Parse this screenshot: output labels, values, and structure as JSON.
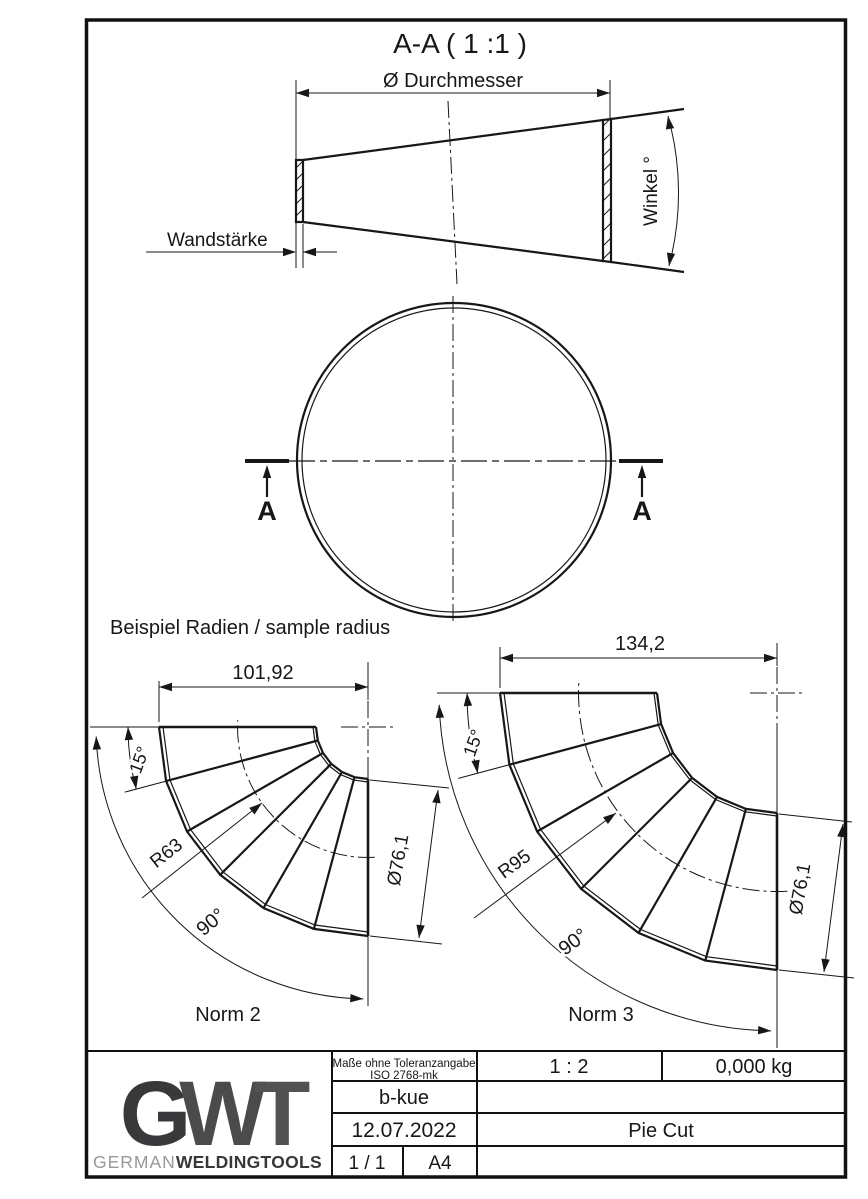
{
  "drawing": {
    "section_title": "A-A ( 1 :1 )",
    "cone": {
      "diameter_label": "Ø Durchmesser",
      "wall_label": "Wandstärke",
      "angle_label": "Winkel °"
    },
    "section_marks": {
      "left": "A",
      "right": "A"
    },
    "samples": {
      "heading": "Beispiel Radien / sample radius",
      "norm2": {
        "width": "101,92",
        "segment_angle": "15°",
        "radius": "R63",
        "bend_angle": "90°",
        "diameter": "Ø76,1",
        "label": "Norm 2"
      },
      "norm3": {
        "width": "134,2",
        "segment_angle": "15°",
        "radius": "R95",
        "bend_angle": "90°",
        "diameter": "Ø76,1",
        "label": "Norm 3"
      }
    }
  },
  "title_block": {
    "tolerance_line1": "Maße ohne Toleranzangabe",
    "tolerance_line2": "ISO 2768-mk",
    "scale": "1 : 2",
    "weight": "0,000 kg",
    "author": "b-kue",
    "date": "12.07.2022",
    "part_name": "Pie Cut",
    "sheet": "1 / 1",
    "format": "A4",
    "logo": {
      "g": "G",
      "w": "W",
      "t": "T",
      "brand_light": "GERMAN",
      "brand_bold": "WELDINGTOOLS"
    }
  },
  "colors": {
    "line": "#171717",
    "logo_dark": "#39393b",
    "logo_mid": "#4b4b4d",
    "logo_light": "#98989a"
  }
}
